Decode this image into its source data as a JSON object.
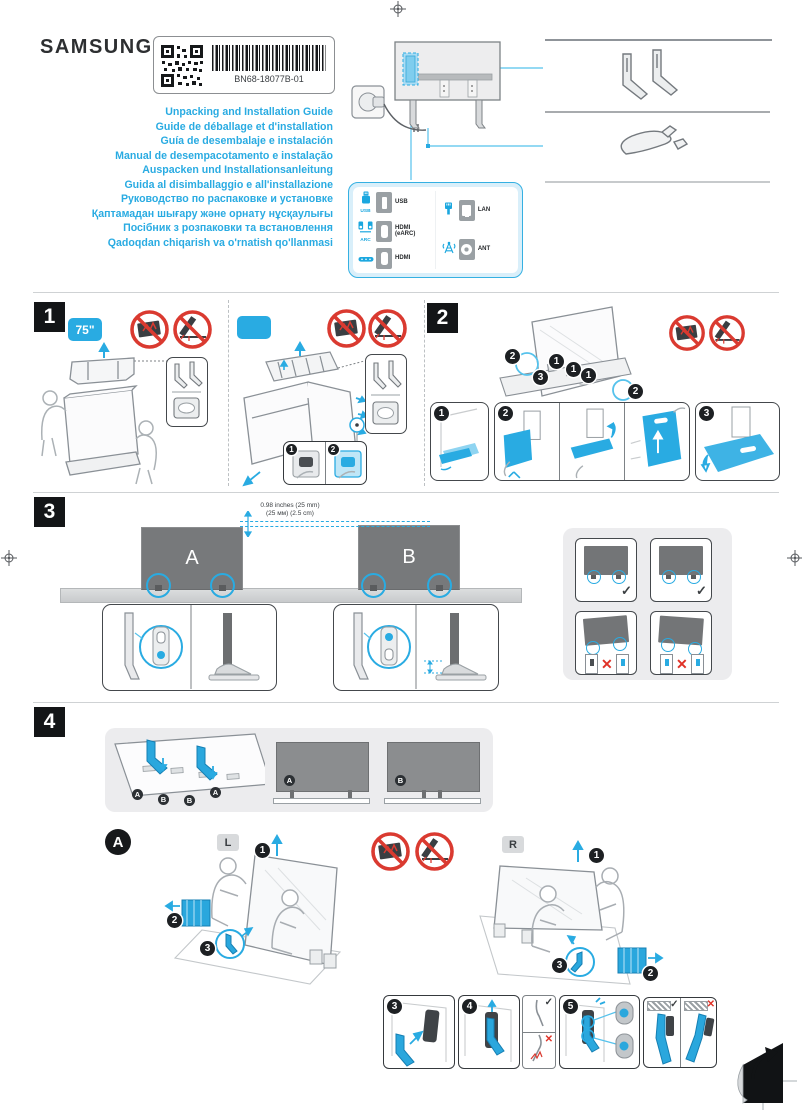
{
  "page": {
    "brand": "SAMSUNG",
    "label": {
      "part_number": "BN68-18077B-01"
    },
    "titles": [
      "Unpacking and Installation Guide",
      "Guide de déballage et d'installation",
      "Guía de desembalaje e instalación",
      "Manual de desempacotamento e instalação",
      "Auspacken und Installationsanleitung",
      "Guida al disimballaggio e all'installazione",
      "Руководство по распаковке и установке",
      "Қаптамадан шығару және орнату нұсқаулығы",
      "Посібник з розпаковки та встановлення",
      "Qadoqdan chiqarish va o'rnatish qo'llanmasi"
    ],
    "colors": {
      "accent": "#29abe2",
      "prohibition": "#da3a30",
      "badge_black": "#131517"
    }
  },
  "ports_panel": {
    "rows_left": [
      {
        "icon": "usb-device-icon",
        "caption": "USB",
        "label": "USB"
      },
      {
        "icon": "arc-speakers-icon",
        "caption": "ARC",
        "label": "HDMI (eARC)"
      },
      {
        "icon": "soundbar-icon",
        "caption": "",
        "label": "HDMI"
      }
    ],
    "rows_right": [
      {
        "icon": "lan-cable-icon",
        "label": "LAN"
      },
      {
        "icon": "antenna-icon",
        "label": "ANT"
      }
    ]
  },
  "sections": {
    "one": {
      "number": "1",
      "size_badge": "75\"",
      "handle_steps": [
        "1",
        "2"
      ]
    },
    "two": {
      "number": "2",
      "callouts": [
        "2",
        "1",
        "1",
        "1",
        "3",
        "2"
      ],
      "steps": [
        "1",
        "2",
        "3"
      ]
    },
    "three": {
      "number": "3",
      "tv_a": "A",
      "tv_b": "B",
      "gap_line1": "0.98 inches (25 mm)",
      "gap_line2": "(25 мм) (2.5 cm)",
      "check": "✓",
      "cross": "✕"
    },
    "four": {
      "number": "4",
      "slot_labels": [
        "A",
        "B",
        "B",
        "A"
      ],
      "tv_a": "A",
      "tv_b": "B"
    },
    "assembly": {
      "label": "A",
      "left": "L",
      "right": "R",
      "left_callouts": [
        "1",
        "2",
        "3"
      ],
      "right_callouts": [
        "1",
        "2",
        "3"
      ],
      "steps": [
        "3",
        "4",
        "5"
      ],
      "check": "✓",
      "cross": "✕"
    }
  }
}
